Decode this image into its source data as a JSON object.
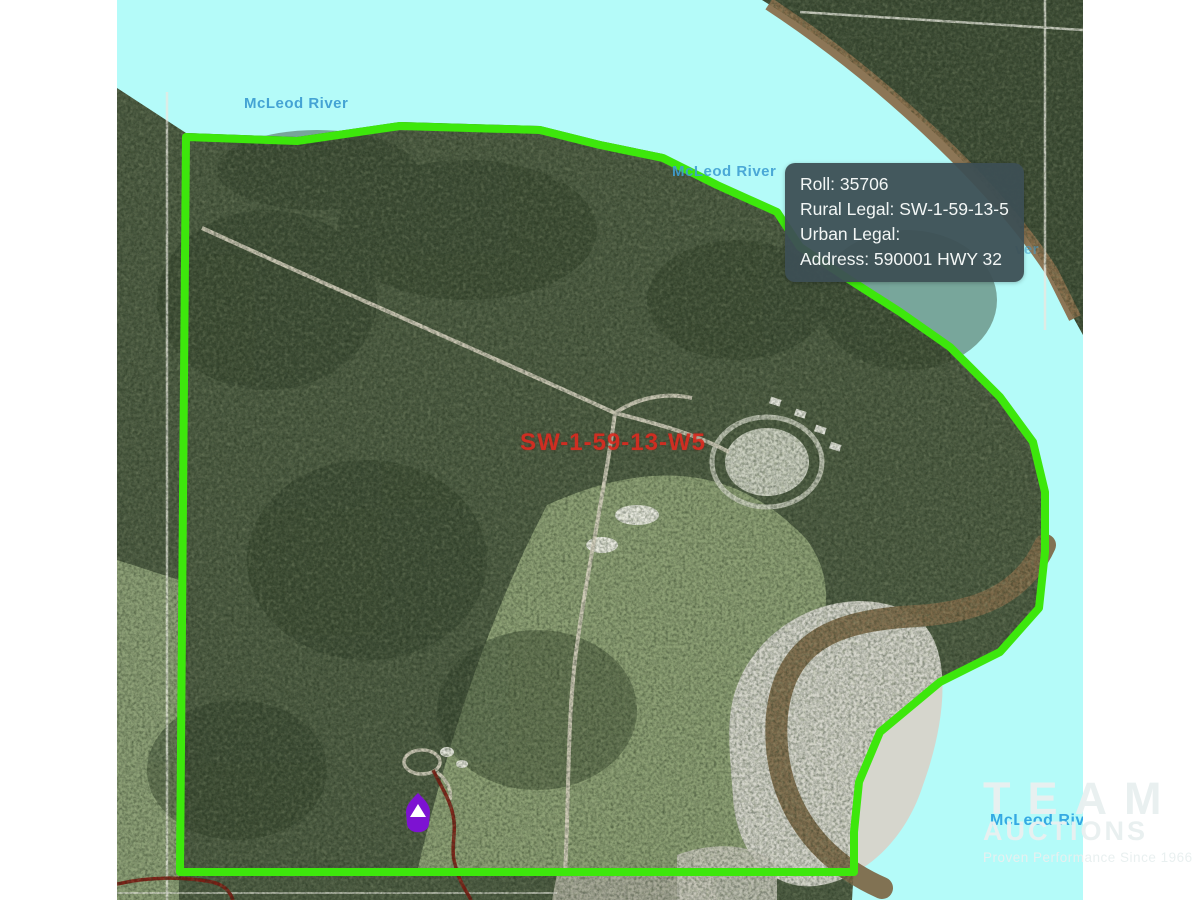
{
  "map": {
    "parcel_label": "SW-1-59-13-W5",
    "tooltip": {
      "lines": [
        {
          "text": "Roll: 35706"
        },
        {
          "text": "Rural Legal: SW-1-59-13-5"
        },
        {
          "text": "Urban Legal:"
        },
        {
          "text": "Address: 590001 HWY 32"
        }
      ]
    },
    "river_labels": {
      "top_left": "McLeod River",
      "near_tooltip": "McLeod River",
      "bottom_right": "McLeod River",
      "fragment_behind_tooltip": "ver"
    },
    "colors": {
      "water": "#b4fbf9",
      "boundary_green": "#3de70c",
      "tooltip_bg": "#3d4f54",
      "parcel_label_red": "#da2b20",
      "river_label_blue": "#3f9fd2",
      "marker_purple": "#7d12d2",
      "road_dark_red": "#7b1b12"
    }
  },
  "watermark": {
    "line1": "TEAM",
    "line2": "AUCTIONS",
    "tagline": "Proven Performance Since 1966"
  }
}
